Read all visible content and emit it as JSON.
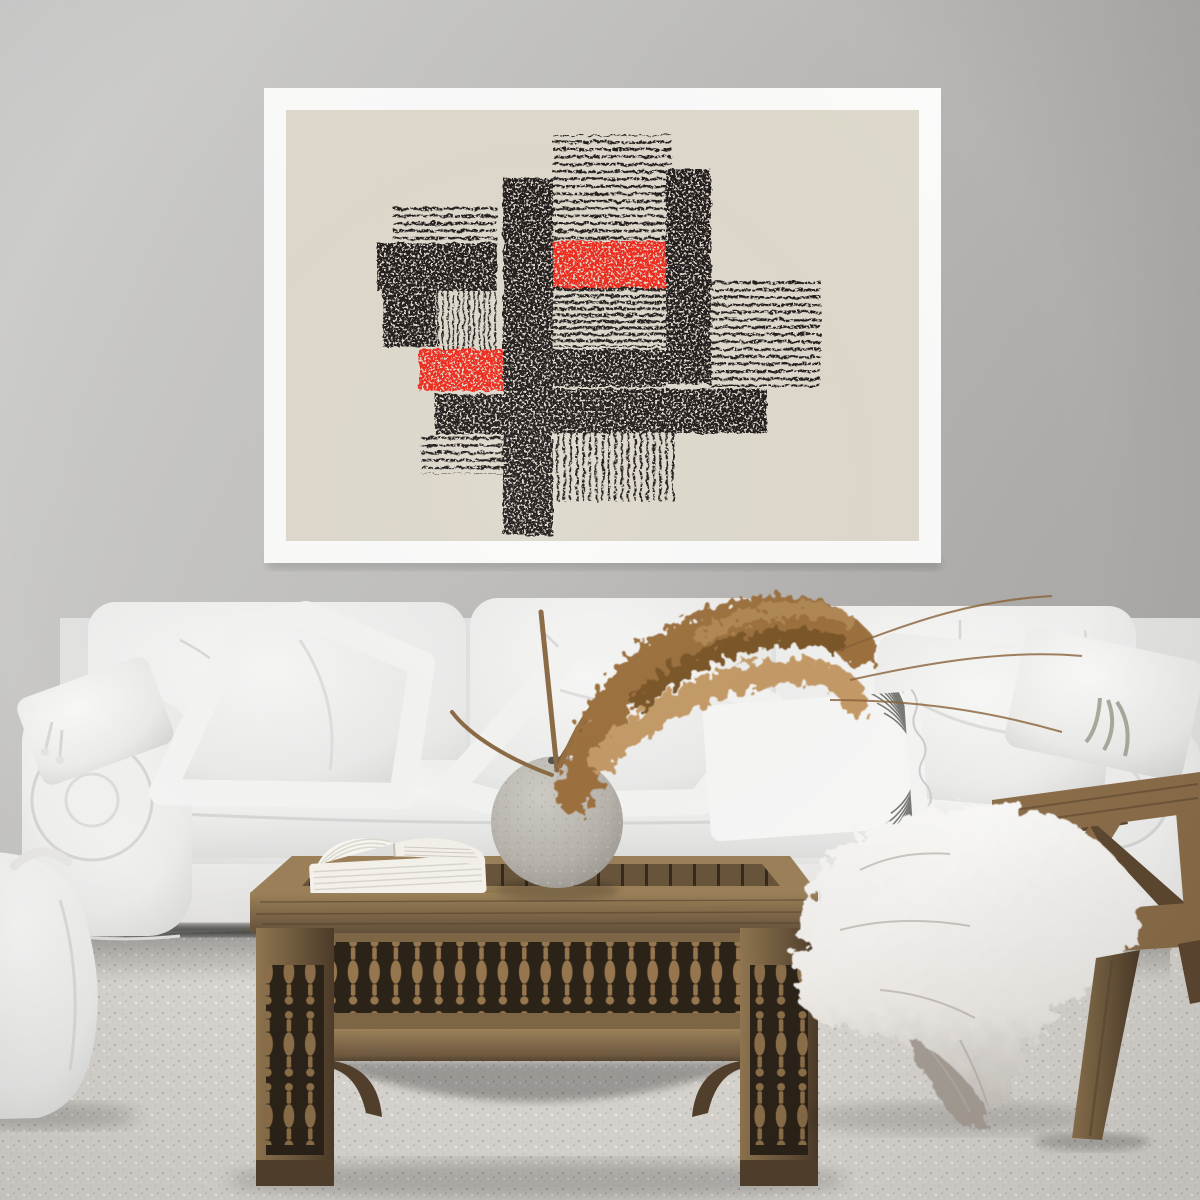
{
  "scene_labels": {
    "wall": "Light gray wall",
    "poster": "Framed abstract black and red block-print poster",
    "artwork": "Abstract linocut composition of woven black bars, hatched stripe blocks and two red rectangles on beige paper",
    "sofa": "White slipcovered sofa with loose cushions",
    "pillow_tassel": "Small white tassel pillow",
    "pillow_left": "Large leaning white pillow",
    "pillow_center": "White diamond pillow",
    "pillow_striped": "White lumbar pillow with thin curved stripes and ruffled flange",
    "pillow_right": "White pillow",
    "pillow_ties": "White pillow with fabric ties",
    "pampas": "Dried pampas grass stems",
    "vase": "Round gray stone sphere vase",
    "book": "Open book lying on table",
    "table": "Carved oriental wooden coffee table with spindle apron",
    "pouf": "White fabric pouf with handle",
    "chair": "Wooden lounge chair",
    "fur": "White sheepskin throw draped over chair",
    "carpet": "Light speckled carpet",
    "vignette": "Soft photographic lighting vignette"
  },
  "colors": {
    "wall-light": "#cdcdcc",
    "wall-mid": "#c2c1bf",
    "wall-dark": "#adabaa",
    "frame": "#fbfbfa",
    "paper": "#ded9cc",
    "ink": "#211f1c",
    "red": "#ef2a1e",
    "sofa": "#f3f3f2",
    "sofa-shade": "#d9d9d8",
    "skirt": "#ecebe9",
    "under-shadow": "#33312e",
    "floor": "#d8d5d0",
    "speck-dark": "#b7b3ac",
    "speck-light": "#efeee9",
    "wood": "#7d6646",
    "wood-dark": "#52402c",
    "wood-light": "#a0855d",
    "wood-deep": "#2b2218",
    "chair-wood": "#8b6d49",
    "chair-wood-dark": "#5e4831",
    "chair-wood-light": "#b2925f",
    "fur": "#f6f5f3",
    "fur-shade": "#c9c4be",
    "fur-tail": "#a19a92",
    "pampas": "#9c6f3e",
    "pampas-light": "#c49a66",
    "pampas-dark": "#7a5527",
    "vase": "#b6b2ab",
    "vase-dark": "#8e8a83",
    "vase-light": "#d2cfc9",
    "book": "#f5f2ec",
    "pouf": "#f0efed",
    "stripe": "#63635e"
  }
}
